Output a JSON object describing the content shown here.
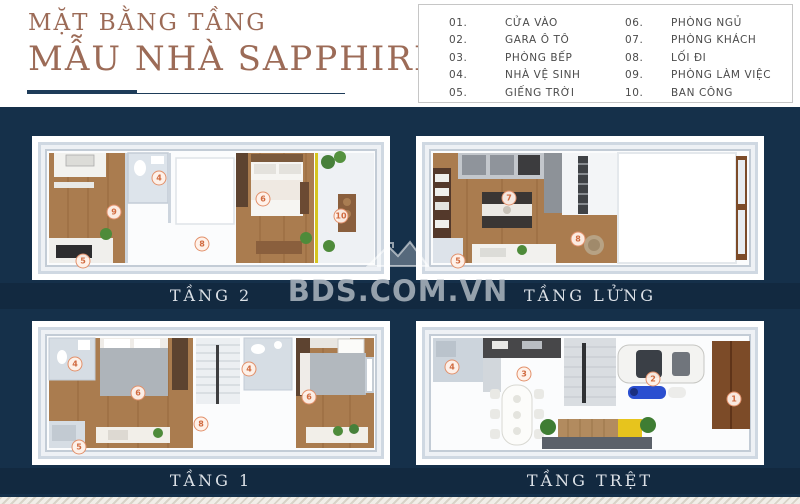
{
  "header": {
    "title_line1": "MẶT BẰNG TẦNG",
    "title_line2": "MẪU NHÀ SAPPHIRE"
  },
  "legend": {
    "items": [
      {
        "num": "01.",
        "label": "CỬA VÀO"
      },
      {
        "num": "02.",
        "label": "GARA Ô TÔ"
      },
      {
        "num": "03.",
        "label": "PHÒNG BẾP"
      },
      {
        "num": "04.",
        "label": "NHÀ VỆ SINH"
      },
      {
        "num": "05.",
        "label": "GIẾNG TRỜI"
      },
      {
        "num": "06.",
        "label": "PHÒNG NGỦ"
      },
      {
        "num": "07.",
        "label": "PHÒNG KHÁCH"
      },
      {
        "num": "08.",
        "label": "LỐI ĐI"
      },
      {
        "num": "09.",
        "label": "PHÒNG LÀM VIỆC"
      },
      {
        "num": "10.",
        "label": "BAN CÔNG"
      }
    ]
  },
  "watermark": {
    "text": "BDS.COM.VN"
  },
  "floors": [
    {
      "label": "TẦNG 2",
      "markers": [
        {
          "n": "9"
        },
        {
          "n": "4"
        },
        {
          "n": "8"
        },
        {
          "n": "5"
        },
        {
          "n": "6"
        },
        {
          "n": "10"
        }
      ]
    },
    {
      "label": "TẦNG LỬNG",
      "markers": [
        {
          "n": "7"
        },
        {
          "n": "8"
        },
        {
          "n": "5"
        }
      ]
    },
    {
      "label": "TẦNG 1",
      "markers": [
        {
          "n": "4"
        },
        {
          "n": "6"
        },
        {
          "n": "8"
        },
        {
          "n": "4"
        },
        {
          "n": "6"
        },
        {
          "n": "5"
        }
      ]
    },
    {
      "label": "TẦNG TRỆT",
      "markers": [
        {
          "n": "4"
        },
        {
          "n": "3"
        },
        {
          "n": "2"
        },
        {
          "n": "1"
        }
      ]
    }
  ],
  "colors": {
    "navy": "#15304a",
    "title_accent": "#9c6b57",
    "underline": "#1e3c59",
    "marker_orange": "#d06a3f",
    "wood_floor": "#aa7c4f",
    "balcony_line_yellow": "#d6c51f",
    "crossing_yellow": "#e7c41d"
  }
}
